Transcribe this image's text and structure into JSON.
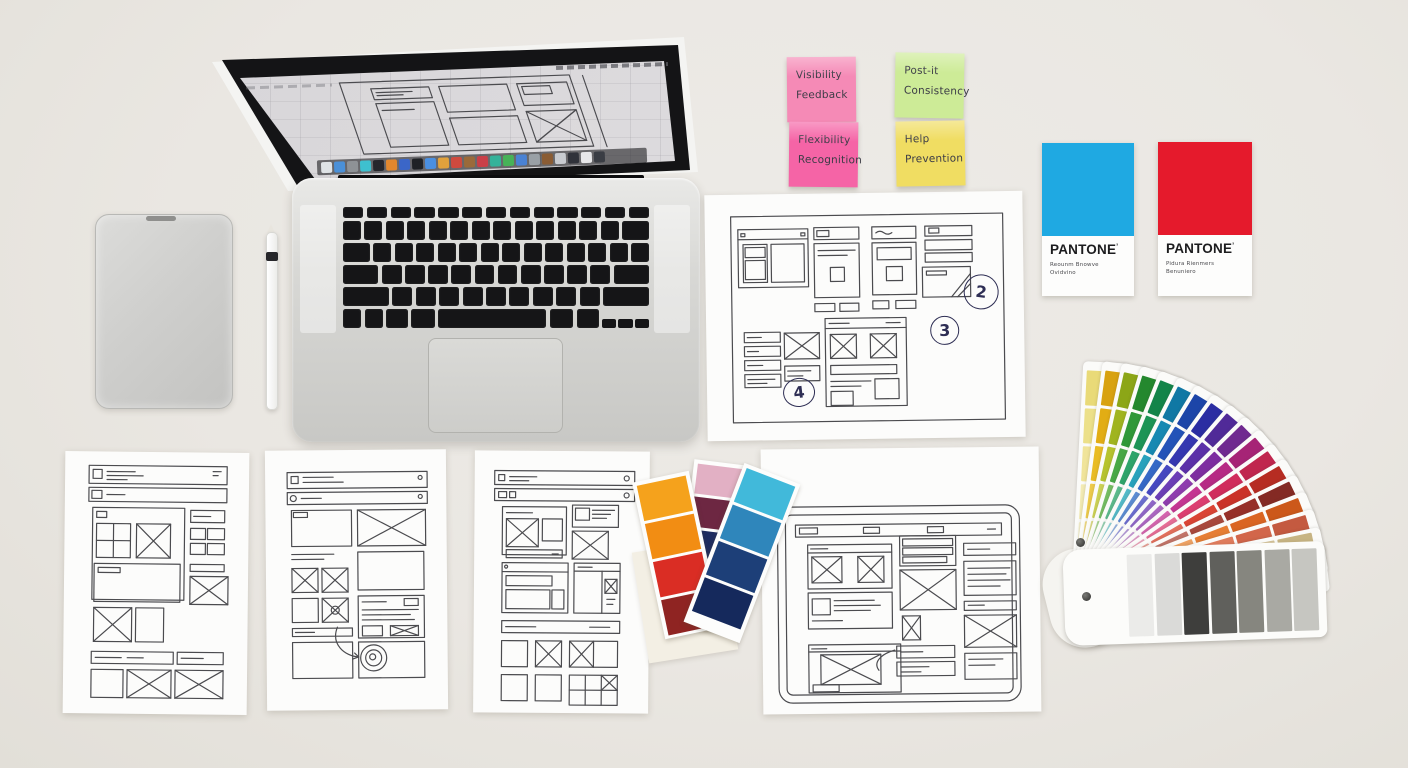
{
  "sticky_notes": [
    {
      "color": "#f58ab6",
      "lines": [
        "Visibility",
        "Feedback"
      ]
    },
    {
      "color": "#cdeb97",
      "lines": [
        "Post-it",
        "Consistency"
      ]
    },
    {
      "color": "#f564a6",
      "lines": [
        "Flexibility",
        "Recognition"
      ]
    },
    {
      "color": "#f0dd62",
      "lines": [
        "Help",
        "Prevention"
      ]
    }
  ],
  "pantone_cards": [
    {
      "brand": "PANTONE",
      "mark": "’",
      "color": "#1fa9e2",
      "caption_lines": [
        "Reounm Bnowve",
        "Ovidvino"
      ]
    },
    {
      "brand": "PANTONE",
      "mark": "’",
      "color": "#e51a2c",
      "caption_lines": [
        "Pidura Rienmers",
        "Benuniero"
      ]
    }
  ],
  "annotations": {
    "sheet_top": [
      "2",
      "3",
      "4"
    ]
  },
  "laptop": {
    "dock_icon_colors": [
      "#dfe3e6",
      "#4a90d8",
      "#8e9296",
      "#3ec0cf",
      "#26262c",
      "#e2872e",
      "#3b66c8",
      "#1f2125",
      "#4a8fe0",
      "#e0a13c",
      "#cf4a3e",
      "#9a6a3a",
      "#c93f48",
      "#35b29a",
      "#47b258",
      "#4a82d4",
      "#9aa0a6",
      "#8a5c34",
      "#c8cbd0",
      "#30323a",
      "#e8e8ea",
      "#3a3d44"
    ]
  },
  "color_fan": {
    "strips": [
      {
        "colors": [
          "#f6f1cd",
          "#f3ebb4",
          "#f0e49a",
          "#ece089",
          "#e9da78"
        ]
      },
      {
        "colors": [
          "#f2dc82",
          "#eecb4a",
          "#e9bc24",
          "#e2ad14",
          "#d8a210"
        ]
      },
      {
        "colors": [
          "#dedc86",
          "#ccd254",
          "#b6c32e",
          "#a0b41f",
          "#8ca617"
        ]
      },
      {
        "colors": [
          "#aad694",
          "#74bd62",
          "#48a846",
          "#309838",
          "#24882e"
        ]
      },
      {
        "colors": [
          "#96d2b4",
          "#5cba8c",
          "#2ea46a",
          "#1d9456",
          "#138449"
        ]
      },
      {
        "colors": [
          "#92d6da",
          "#54bac8",
          "#28a2bc",
          "#1789b2",
          "#1078a4"
        ]
      },
      {
        "colors": [
          "#94b4e2",
          "#5c8cd2",
          "#3568c6",
          "#2353b8",
          "#1c45a8"
        ]
      },
      {
        "colors": [
          "#9c9ee0",
          "#6c6ed0",
          "#4648c0",
          "#3537b0",
          "#2b2da2"
        ]
      },
      {
        "colors": [
          "#b49ada",
          "#9068c8",
          "#6c3eb6",
          "#5c30a8",
          "#502a98"
        ]
      },
      {
        "colors": [
          "#c89ad6",
          "#ac68c2",
          "#8e3cae",
          "#7e2ea0",
          "#702a90"
        ]
      },
      {
        "colors": [
          "#e29cca",
          "#d466ae",
          "#c43692",
          "#b62a84",
          "#a62476"
        ]
      },
      {
        "colors": [
          "#eea4bc",
          "#e66e96",
          "#dc3e70",
          "#d02c5c",
          "#c0264e"
        ]
      },
      {
        "colors": [
          "#eca49a",
          "#e4705c",
          "#da4434",
          "#ca3228",
          "#b62c22"
        ]
      },
      {
        "colors": [
          "#daa8a0",
          "#c27468",
          "#a8483c",
          "#962f28",
          "#842a24"
        ]
      },
      {
        "colors": [
          "#f4c8a0",
          "#eda264",
          "#e67e34",
          "#da6522",
          "#cc581a"
        ]
      },
      {
        "colors": [
          "#f2cabb",
          "#e9a287",
          "#df7c5c",
          "#d2664a",
          "#c45a40"
        ]
      },
      {
        "colors": [
          "#f3eee2",
          "#eae1cb",
          "#dfd2b2",
          "#d3c298",
          "#c7b483"
        ]
      },
      {
        "colors": [
          "#e0e0de",
          "#cacac8",
          "#a0a09c",
          "#50504c",
          "#2a2a28"
        ]
      }
    ],
    "front_strip": {
      "colors": [
        "#ebebe9",
        "#dadad8",
        "#3e3e3c",
        "#60605c",
        "#86867f",
        "#a9a9a3",
        "#c6c6c1"
      ]
    }
  },
  "swatch_cards": [
    {
      "colors": [
        "#f5a21c",
        "#f28d13",
        "#da2d24",
        "#8f2422"
      ]
    },
    {
      "colors": [
        "#e2b0c4",
        "#6d2742",
        "#1e2c60",
        "#17234e"
      ],
      "has_label": true
    },
    {
      "colors": [
        "#41b9da",
        "#2f86bb",
        "#1d3f78",
        "#15295c"
      ]
    }
  ]
}
